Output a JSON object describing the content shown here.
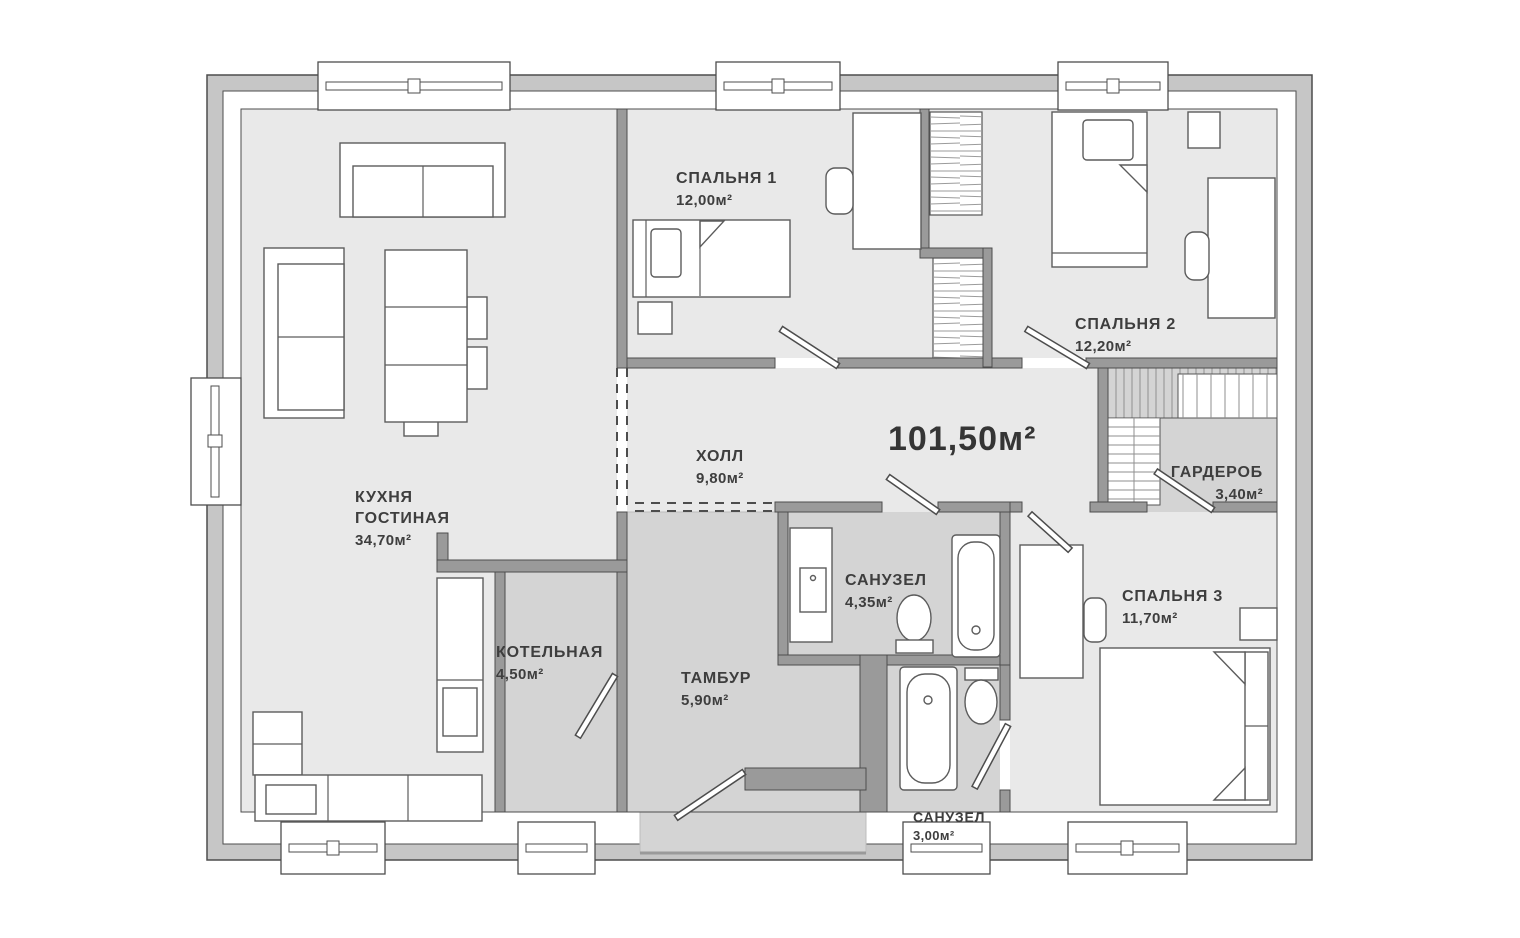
{
  "floor_plan": {
    "total_area": "101,50м²",
    "rooms": [
      {
        "id": "kitchen-living",
        "name": "КУХНЯ\nГОСТИНАЯ",
        "area": "34,70м²"
      },
      {
        "id": "bedroom-1",
        "name": "СПАЛЬНЯ 1",
        "area": "12,00м²"
      },
      {
        "id": "bedroom-2",
        "name": "СПАЛЬНЯ 2",
        "area": "12,20м²"
      },
      {
        "id": "hall",
        "name": "ХОЛЛ",
        "area": "9,80м²"
      },
      {
        "id": "wardrobe",
        "name": "ГАРДЕРОБ",
        "area": "3,40м²"
      },
      {
        "id": "bathroom-1",
        "name": "САНУЗЕЛ",
        "area": "4,35м²"
      },
      {
        "id": "bedroom-3",
        "name": "СПАЛЬНЯ 3",
        "area": "11,70м²"
      },
      {
        "id": "boiler-room",
        "name": "КОТЕЛЬНАЯ",
        "area": "4,50м²"
      },
      {
        "id": "vestibule",
        "name": "ТАМБУР",
        "area": "5,90м²"
      },
      {
        "id": "bathroom-2",
        "name": "САНУЗЕЛ",
        "area": "3,00м²"
      }
    ],
    "colors": {
      "room_light": "#e9e9e9",
      "room_service": "#d4d4d4",
      "outer_wall_band": "#c6c6c6",
      "wall_line": "#4d4d4d",
      "text": "#3e3e3e"
    }
  }
}
